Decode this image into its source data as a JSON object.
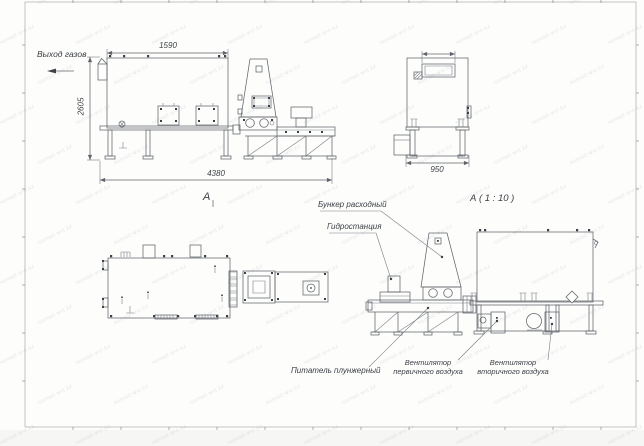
{
  "drawing": {
    "labels": {
      "gas_outlet": "Выход газов",
      "bunker": "Бункер расходный",
      "hydro_station": "Гидростанция",
      "plunger_feeder": "Питатель плунжерный",
      "primary_fan_line1": "Вентилятор",
      "primary_fan_line2": "первичного воздуха",
      "secondary_fan_line1": "Вентилятор",
      "secondary_fan_line2": "вторичного воздуха",
      "view_a": "А",
      "view_a_scale": "А ( 1 : 10 )"
    },
    "dimensions": {
      "furnace_top_length": "1590",
      "overall_height": "2605",
      "overall_length": "4380",
      "end_view_width": "950"
    },
    "colors": {
      "line": "#60646a",
      "text": "#3b3f45",
      "frame": "#b3b3b3",
      "sheet": "#fdfdfc",
      "background": "#f6f6f4"
    },
    "watermark": {
      "text": "nomad-wvr.kz"
    },
    "views": [
      "side-view-main",
      "end-view",
      "plan-view",
      "side-view-a-1-10"
    ]
  }
}
